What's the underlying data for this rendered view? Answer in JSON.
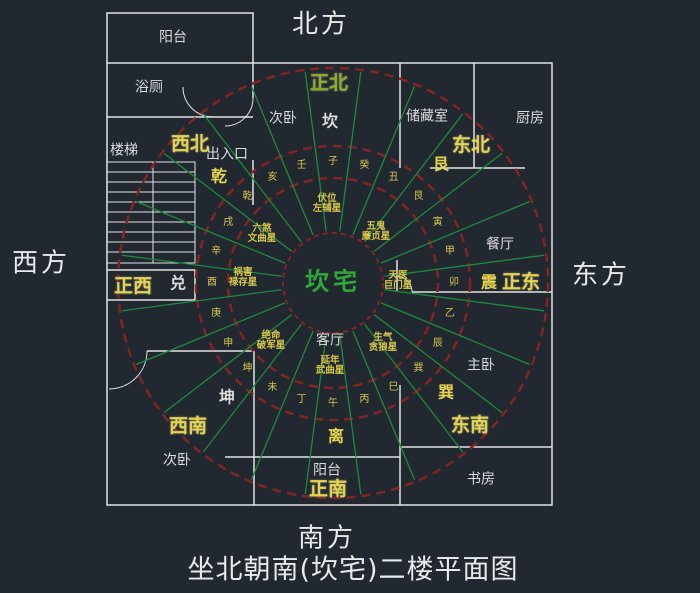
{
  "title": "坐北朝南(坎宅)二楼平面图",
  "colors": {
    "background": "#212830",
    "wall": "#e3e3e3",
    "ring_red": "#832424",
    "ray_green": "#1d8a3e",
    "gold": "#e6d44f",
    "white_text": "#dcdcdc",
    "center_green": "#2fa937",
    "north_label_green": "#8fae2a"
  },
  "center": {
    "label": "坎宅",
    "x": 333,
    "y": 282,
    "color": "#2fa937"
  },
  "compass": {
    "cx": 333,
    "cy": 283,
    "circle_radii": [
      50,
      105,
      137,
      215
    ],
    "ray_count": 24,
    "ray_offset_deg": 7.5,
    "ray_step_deg": 15,
    "ray_inner": 52,
    "ray_outer": 213,
    "mountain_radius": 121
  },
  "cardinals": [
    {
      "name": "north-label",
      "text": "北方",
      "x": 321,
      "y": 25
    },
    {
      "name": "south-label",
      "text": "南方",
      "x": 327,
      "y": 539
    },
    {
      "name": "west-label",
      "text": "西方",
      "x": 41,
      "y": 264
    },
    {
      "name": "east-label",
      "text": "东方",
      "x": 601,
      "y": 276
    }
  ],
  "directions": [
    {
      "name": "due-north",
      "text": "正北",
      "x": 329,
      "y": 84,
      "color": "#8fae2a"
    },
    {
      "name": "northwest",
      "text": "西北",
      "x": 190,
      "y": 145,
      "color": "#e6d44f"
    },
    {
      "name": "northeast",
      "text": "东北",
      "x": 471,
      "y": 146,
      "color": "#e6d44f"
    },
    {
      "name": "due-west",
      "text": "正西",
      "x": 133,
      "y": 287,
      "color": "#e6d44f"
    },
    {
      "name": "due-east",
      "text": "正东",
      "x": 521,
      "y": 283,
      "color": "#e6d44f"
    },
    {
      "name": "southwest",
      "text": "西南",
      "x": 188,
      "y": 427,
      "color": "#e6d44f"
    },
    {
      "name": "southeast",
      "text": "东南",
      "x": 470,
      "y": 426,
      "color": "#e6d44f"
    },
    {
      "name": "due-south",
      "text": "正南",
      "x": 328,
      "y": 490,
      "color": "#e6d44f"
    }
  ],
  "trigrams": [
    {
      "name": "qian",
      "text": "乾",
      "x": 219,
      "y": 177,
      "color": "#e6d44f"
    },
    {
      "name": "kan",
      "text": "坎",
      "x": 330,
      "y": 122,
      "color": "#dcdcdc"
    },
    {
      "name": "gen",
      "text": "艮",
      "x": 441,
      "y": 165,
      "color": "#e6d44f"
    },
    {
      "name": "zhen",
      "text": "震",
      "x": 489,
      "y": 283,
      "color": "#e6d44f"
    },
    {
      "name": "xun",
      "text": "巽",
      "x": 446,
      "y": 393,
      "color": "#e6d44f"
    },
    {
      "name": "li",
      "text": "离",
      "x": 336,
      "y": 437,
      "color": "#e6d44f"
    },
    {
      "name": "dui",
      "text": "兑",
      "x": 178,
      "y": 284,
      "color": "#dcdcdc"
    },
    {
      "name": "kun",
      "text": "坤",
      "x": 227,
      "y": 398,
      "color": "#dcdcdc"
    }
  ],
  "stars": [
    {
      "name": "fuwei",
      "line1": "伏位",
      "line2": "左辅星",
      "x": 327,
      "y": 204
    },
    {
      "name": "wugui",
      "line1": "五鬼",
      "line2": "廉贞星",
      "x": 376,
      "y": 232
    },
    {
      "name": "tianyi",
      "line1": "天医",
      "line2": "巨门星",
      "x": 398,
      "y": 281
    },
    {
      "name": "shengqi",
      "line1": "生气",
      "line2": "贪狼星",
      "x": 383,
      "y": 343
    },
    {
      "name": "yannian",
      "line1": "延年",
      "line2": "武曲星",
      "x": 330,
      "y": 366
    },
    {
      "name": "jueming",
      "line1": "绝命",
      "line2": "破军星",
      "x": 271,
      "y": 341
    },
    {
      "name": "huohai",
      "line1": "祸害",
      "line2": "禄存星",
      "x": 243,
      "y": 278
    },
    {
      "name": "liusha",
      "line1": "六煞",
      "line2": "文曲星",
      "x": 262,
      "y": 234
    }
  ],
  "mountain_ring": [
    {
      "text": "子",
      "bearing": 0
    },
    {
      "text": "癸",
      "bearing": 15
    },
    {
      "text": "丑",
      "bearing": 30
    },
    {
      "text": "艮",
      "bearing": 45
    },
    {
      "text": "寅",
      "bearing": 60
    },
    {
      "text": "甲",
      "bearing": 75
    },
    {
      "text": "卯",
      "bearing": 90
    },
    {
      "text": "乙",
      "bearing": 105
    },
    {
      "text": "辰",
      "bearing": 120
    },
    {
      "text": "巽",
      "bearing": 135
    },
    {
      "text": "巳",
      "bearing": 150
    },
    {
      "text": "丙",
      "bearing": 165
    },
    {
      "text": "午",
      "bearing": 180
    },
    {
      "text": "丁",
      "bearing": 195
    },
    {
      "text": "未",
      "bearing": 210
    },
    {
      "text": "坤",
      "bearing": 225
    },
    {
      "text": "申",
      "bearing": 240
    },
    {
      "text": "庚",
      "bearing": 255
    },
    {
      "text": "酉",
      "bearing": 270
    },
    {
      "text": "辛",
      "bearing": 285
    },
    {
      "text": "戌",
      "bearing": 300
    },
    {
      "text": "乾",
      "bearing": 315
    },
    {
      "text": "亥",
      "bearing": 330
    },
    {
      "text": "壬",
      "bearing": 345
    }
  ],
  "rooms": [
    {
      "name": "balcony-nw",
      "text": "阳台",
      "x": 173,
      "y": 38
    },
    {
      "name": "bathroom",
      "text": "浴厕",
      "x": 149,
      "y": 88
    },
    {
      "name": "stairs",
      "text": "楼梯",
      "x": 124,
      "y": 151
    },
    {
      "name": "entrance",
      "text": "出入口",
      "x": 227,
      "y": 155
    },
    {
      "name": "bedroom-north",
      "text": "次卧",
      "x": 283,
      "y": 119
    },
    {
      "name": "storage-room",
      "text": "储藏室",
      "x": 427,
      "y": 117
    },
    {
      "name": "kitchen",
      "text": "厨房",
      "x": 530,
      "y": 119
    },
    {
      "name": "dining-room",
      "text": "餐厅",
      "x": 500,
      "y": 245
    },
    {
      "name": "master-bedroom",
      "text": "主卧",
      "x": 481,
      "y": 366
    },
    {
      "name": "study",
      "text": "书房",
      "x": 481,
      "y": 480
    },
    {
      "name": "bedroom-sw",
      "text": "次卧",
      "x": 177,
      "y": 461
    },
    {
      "name": "balcony-south",
      "text": "阳台",
      "x": 327,
      "y": 471
    },
    {
      "name": "living-room",
      "text": "客厅",
      "x": 330,
      "y": 341
    }
  ]
}
